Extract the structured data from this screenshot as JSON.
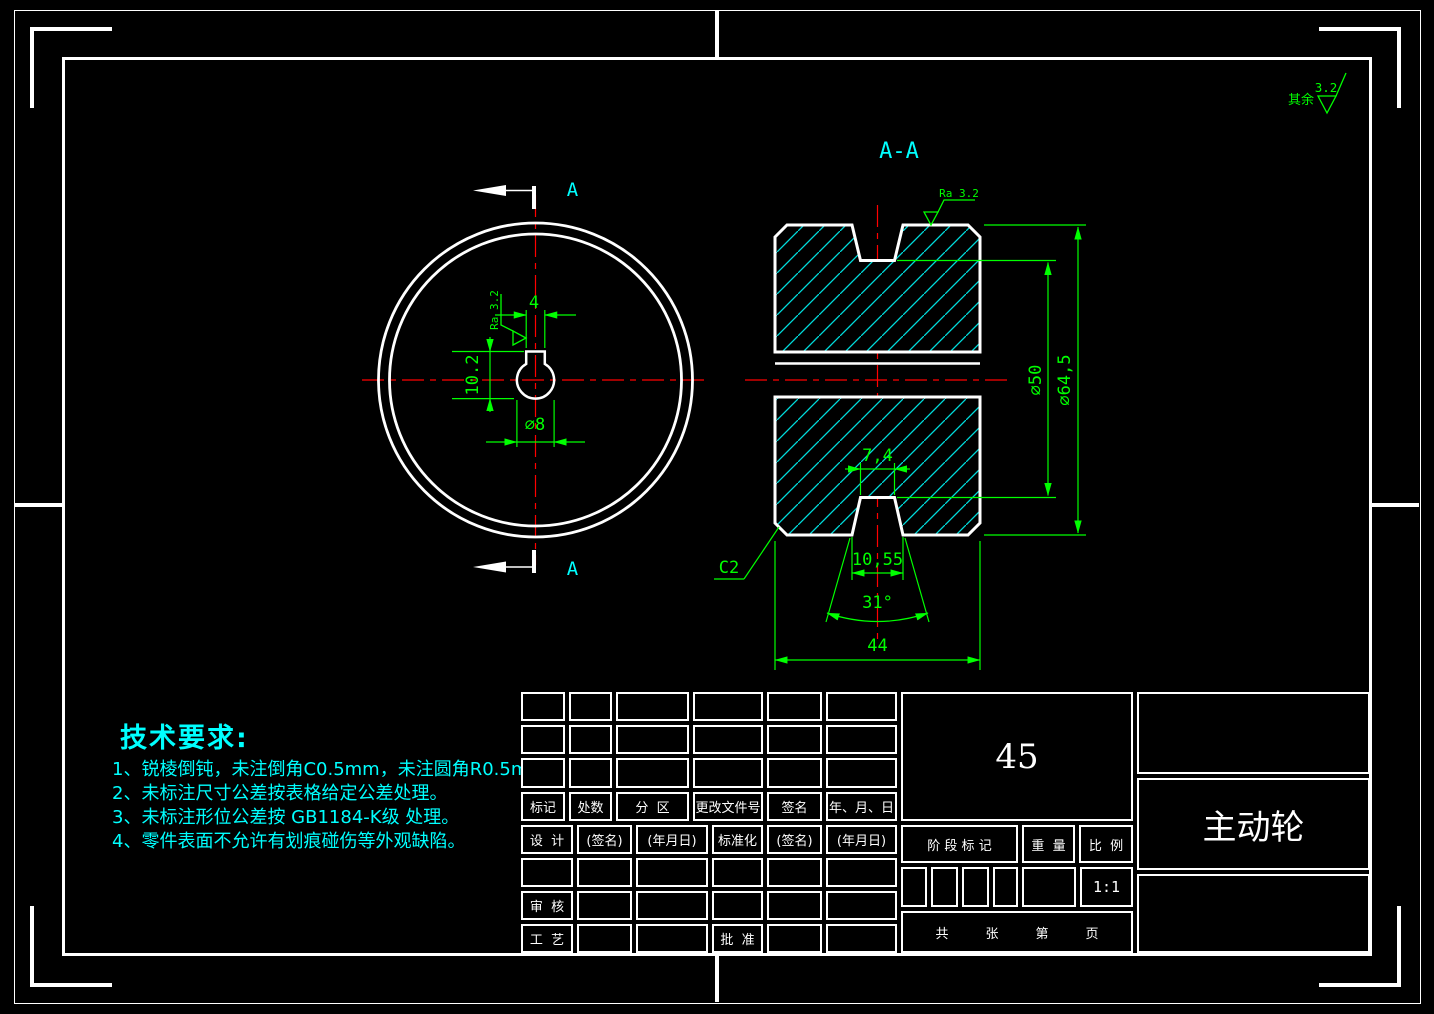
{
  "general_note": {
    "prefix": "其余",
    "roughness": "3.2"
  },
  "section": {
    "label": "A-A",
    "cut_arrow_label": "A"
  },
  "front_view_dims": {
    "keyway_width": "4",
    "keyway_height": "10.2",
    "bore_dia": "∅8",
    "surface": "Ra 3.2"
  },
  "section_dims": {
    "groove_root_dia": "∅50",
    "outer_dia": "∅64,5",
    "groove_bottom_width": "7,4",
    "groove_top_width": "10,55",
    "groove_angle": "31°",
    "overall_width": "44",
    "chamfer": "C2",
    "surface": "Ra 3.2"
  },
  "tech_requirements": {
    "title": "技术要求:",
    "items": [
      "1、锐棱倒钝，未注倒角C0.5mm，未注圆角R0.5mm。",
      "2、未标注尺寸公差按表格给定公差处理。",
      "3、未标注形位公差按 GB1184-K级 处理。",
      "4、零件表面不允许有划痕碰伤等外观缺陷。"
    ]
  },
  "title_block": {
    "revision_headers": [
      "标记",
      "处数",
      "分  区",
      "更改文件号",
      "签名",
      "年、月、日"
    ],
    "sign_row": [
      "设  计",
      "(签名)",
      "(年月日)",
      "标准化",
      "(签名)",
      "(年月日)"
    ],
    "check_label": "审  核",
    "craft_label": "工  艺",
    "approve_label": "批  准",
    "stage_label": "阶 段 标 记",
    "weight_label": "重  量",
    "scale_label": "比  例",
    "scale_value": "1:1",
    "material": "45",
    "part_name": "主动轮",
    "sheet": [
      "共",
      "张",
      "第",
      "页"
    ]
  },
  "colors": {
    "background": "#000000",
    "outline": "#ffffff",
    "dimension": "#00ff00",
    "centerline": "#ff0000",
    "hatch": "#00dddd",
    "annotation": "#00ffff"
  }
}
